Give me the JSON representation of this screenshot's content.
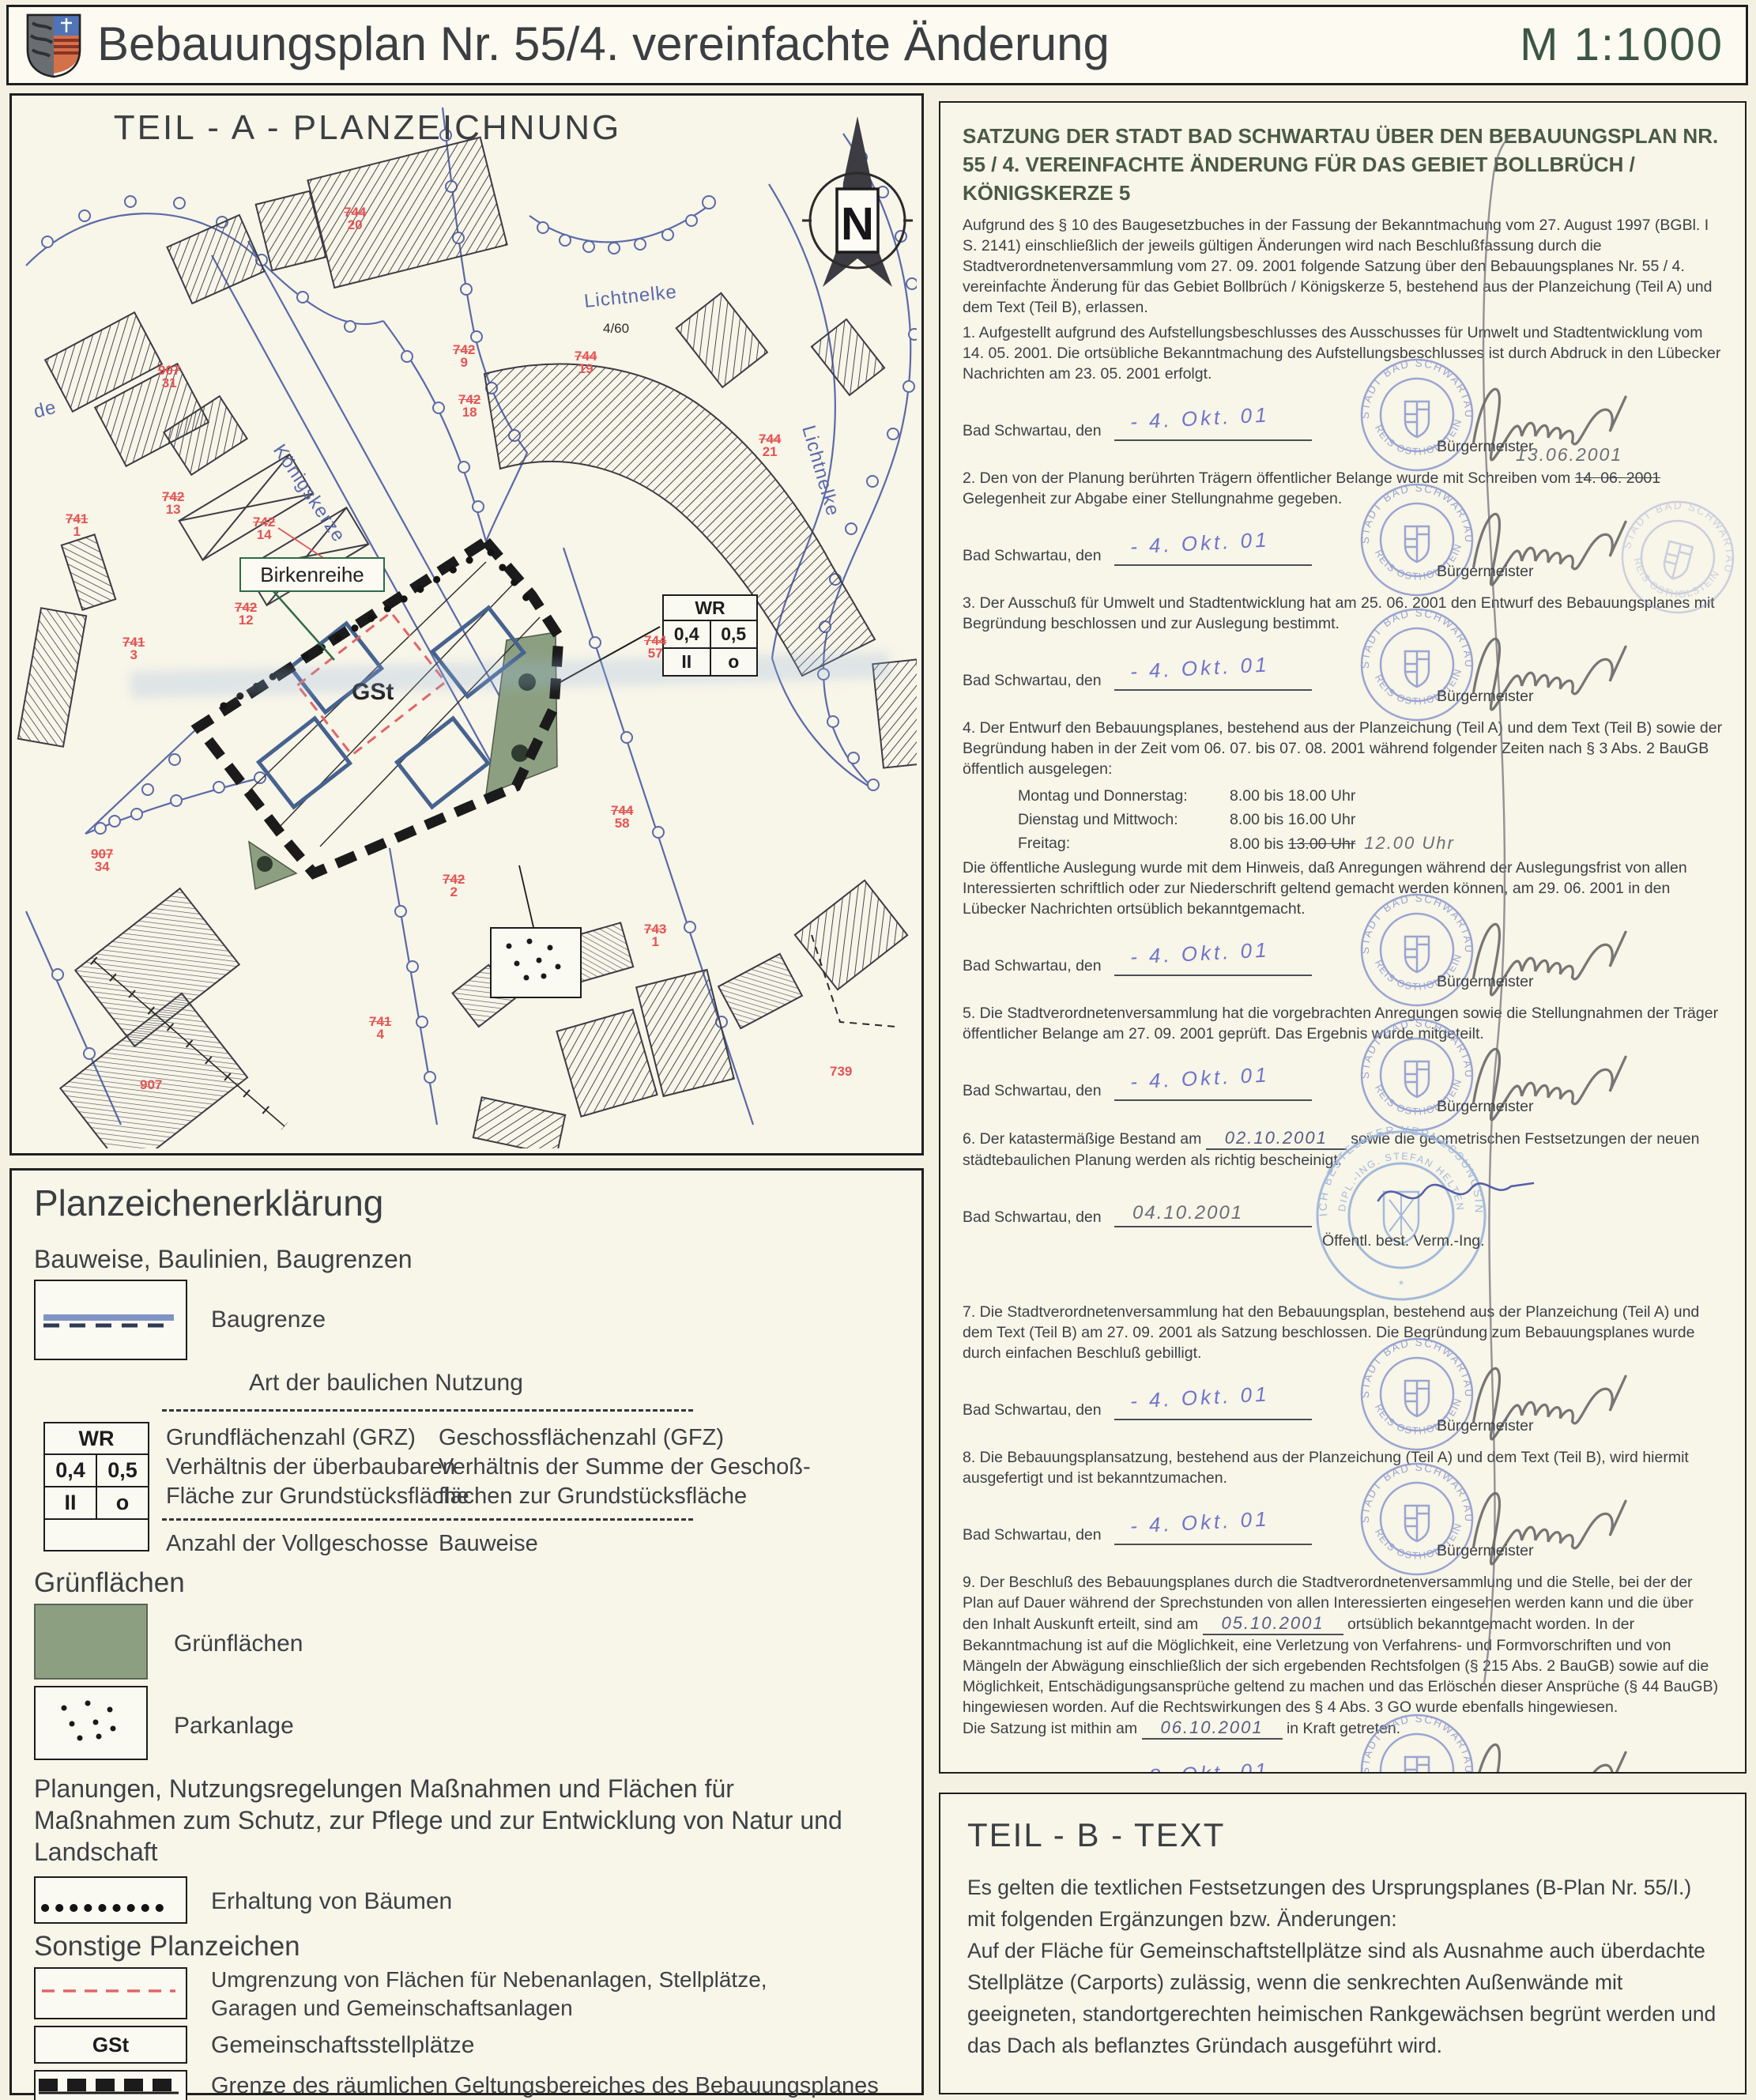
{
  "header": {
    "title": "Bebauungsplan Nr. 55/4. vereinfachte Änderung",
    "scale": "M 1:1000"
  },
  "plan": {
    "title": "TEIL - A - PLANZEICHNUNG",
    "north": "N",
    "streets": {
      "lichtnelke_top": "Lichtnelke",
      "lichtnelke_right": "Lichtnelke",
      "koenigskerze": "Königskerze",
      "de": "de"
    },
    "birkenreihe": "Birkenreihe",
    "gst": "GSt",
    "flur": "4/60",
    "wr_table": {
      "header": "WR",
      "grz": "0,4",
      "gfz": "0,5",
      "storeys": "II",
      "bauweise": "o"
    },
    "parcels": [
      {
        "top": "744",
        "bottom": "20"
      },
      {
        "top": "907",
        "bottom": "31"
      },
      {
        "top": "742",
        "bottom": "13"
      },
      {
        "top": "741",
        "bottom": "1"
      },
      {
        "top": "742",
        "bottom": "14"
      },
      {
        "top": "742",
        "bottom": "12"
      },
      {
        "top": "741",
        "bottom": "3"
      },
      {
        "top": "742",
        "bottom": "9"
      },
      {
        "top": "742",
        "bottom": "18"
      },
      {
        "top": "744",
        "bottom": "19"
      },
      {
        "top": "744",
        "bottom": "21"
      },
      {
        "top": "744",
        "bottom": "57"
      },
      {
        "top": "744",
        "bottom": "58"
      },
      {
        "top": "742",
        "bottom": "2"
      },
      {
        "top": "743",
        "bottom": "1"
      },
      {
        "top": "907",
        "bottom": "34"
      },
      {
        "top": "741",
        "bottom": "4"
      }
    ],
    "parcels_single": {
      "p907": "907",
      "p739": "739"
    }
  },
  "legend": {
    "title": "Planzeichenerklärung",
    "subtitle": "Bauweise, Baulinien, Baugrenzen",
    "baugrenze": "Baugrenze",
    "art": "Art der baulichen Nutzung",
    "grz": "Grundflächenzahl (GRZ)\nVerhältnis der überbaubaren\nFläche zur Grundstücksfläche",
    "gfz": "Geschossflächenzahl (GFZ)\nVerhältnis der Summe der Geschoß-\nflächen zur Grundstücksfläche",
    "anzahl": "Anzahl der Vollgeschosse",
    "bauweise": "Bauweise",
    "gruen_heading": "Grünflächen",
    "gruen": "Grünflächen",
    "park": "Parkanlage",
    "plan_heading": "Planungen, Nutzungsregelungen Maßnahmen und Flächen für Maßnahmen zum Schutz, zur Pflege und zur Entwicklung von Natur und Landschaft",
    "erhaltung": "Erhaltung von Bäumen",
    "sonstige": "Sonstige Planzeichen",
    "umgrenzung": "Umgrenzung von Flächen für Nebenanlagen, Stellplätze, Garagen und Gemeinschaftsanlagen",
    "gst_sym": "GSt",
    "gst": "Gemeinschaftsstellplätze",
    "grenze": "Grenze des räumlichen Geltungsbereiches des Bebauungsplanes"
  },
  "satzung": {
    "title": "SATZUNG DER STADT BAD SCHWARTAU ÜBER DEN BEBAUUNGSPLAN NR. 55 / 4. VEREINFACHTE ÄNDERUNG FÜR DAS GEBIET BOLLBRÜCH / KÖNIGSKERZE 5",
    "intro": "Aufgrund des § 10 des Baugesetzbuches in der Fassung der Bekanntmachung vom 27. August 1997 (BGBl. I S. 2141) einschließlich der jeweils gültigen Änderungen wird nach Beschlußfassung durch die Stadtverordnetenversammlung vom 27. 09. 2001 folgende Satzung über den Bebauungsplanes Nr. 55 / 4. vereinfachte Änderung für das Gebiet Bollbrüch / Königskerze 5, bestehend aus der Planzeichung (Teil A) und dem Text (Teil B), erlassen.",
    "p1": "1. Aufgestellt aufgrund des Aufstellungsbeschlusses des Ausschusses für Umwelt und Stadtentwicklung vom 14. 05. 2001. Die ortsübliche Bekanntmachung des Aufstellungsbeschlusses ist durch Abdruck in den Lübecker Nachrichten am 23. 05. 2001 erfolgt.",
    "p2a": "2. Den von der Planung berührten Trägern öffentlicher Belange wurde mit Schreiben vom",
    "p2_struck": "14. 06. 2001",
    "p2b": "Gelegenheit  zur Abgabe einer Stellungnahme gegeben.",
    "hw_note": "13.06.2001",
    "p3": "3. Der Ausschuß für Umwelt und Stadtentwicklung hat am  25. 06. 2001 den Entwurf des Bebauungsplanes mit Begründung beschlossen und zur Auslegung bestimmt.",
    "p4a": "4. Der Entwurf den Bebauungsplanes, bestehend aus der Planzeichung (Teil A) und dem Text (Teil B) sowie der Begründung haben in der Zeit vom 06. 07. bis 07. 08. 2001 während folgender Zeiten nach § 3 Abs. 2 BauGB öffentlich ausgelegen:",
    "t1d": "Montag und Donnerstag:",
    "t1v": "8.00 bis 18.00 Uhr",
    "t2d": "Dienstag und Mittwoch:",
    "t2v": "8.00 bis 16.00 Uhr",
    "t3d": "Freitag:",
    "t3v": "8.00 bis",
    "t3_struck": "13.00 Uhr",
    "t3_hw": "12.00 Uhr",
    "p4b": "Die öffentliche Auslegung wurde mit dem Hinweis, daß  Anregungen während der Auslegungsfrist von allen Interessierten schriftlich oder zur Niederschrift geltend gemacht werden können, am 29. 06. 2001 in den Lübecker Nachrichten ortsüblich bekanntgemacht.",
    "p5": "5. Die Stadtverordnetenversammlung hat die vorgebrachten  Anregungen sowie die Stellungnahmen der Träger öffentlicher Belange am 27. 09. 2001 geprüft. Das Ergebnis wurde mitgeteilt.",
    "p6a": "6. Der katastermäßige Bestand am",
    "p6_hw": "02.10.2001",
    "p6b": "sowie die geometrischen Festsetzungen der neuen städtebaulichen Planung werden als richtig bescheinigt.",
    "p7": "7. Die Stadtverordnetenversammlung hat den Bebauungsplan,  bestehend aus der Planzeichung (Teil A) und dem Text (Teil B) am 27. 09. 2001 als Satzung beschlossen. Die Begründung zum Bebauungsplanes wurde durch einfachen Beschluß gebilligt.",
    "p8": "8. Die Bebauungsplansatzung, bestehend aus der Planzeichung (Teil A) und dem Text (Teil B), wird hiermit ausgefertigt und ist bekanntzumachen.",
    "p9a": "9. Der Beschluß des Bebauungsplanes durch die Stadtverordnetenversammlung und die Stelle, bei der der Plan auf Dauer während der Sprechstunden von allen Interessierten eingesehen werden kann und die über den Inhalt Auskunft erteilt, sind am",
    "p9_hw1": "05.10.2001",
    "p9b": "ortsüblich bekanntgemacht worden. In der Bekanntmachung ist auf die Möglichkeit, eine Verletzung von Verfahrens- und Formvorschriften und von Mängeln der Abwägung einschließlich der sich ergebenden Rechtsfolgen (§ 215 Abs. 2 BauGB) sowie auf die Möglichkeit, Entschädigungsansprüche geltend zu machen und das Erlöschen dieser Ansprüche (§ 44 BauGB) hingewiesen worden. Auf die Rechtswirkungen des § 4 Abs. 3 GO wurde ebenfalls hingewiesen.",
    "p9c": "Die Satzung ist mithin am",
    "p9_hw2": "06.10.2001",
    "p9d": "in Kraft getreten.",
    "sig_label": "Bad Schwartau, den",
    "role_mayor": "Bürgermeister",
    "role_surveyor": "Öffentl. best. Verm.-Ing.",
    "d1": "- 4. Okt. 01",
    "d2": "- 4. Okt. 01",
    "d3": "- 4. Okt. 01",
    "d4": "- 4. Okt. 01",
    "d5": "- 4. Okt. 01",
    "d6": "04.10.2001",
    "d7": "- 4. Okt. 01",
    "d8": "- 4. Okt. 01",
    "d9": "- 8. Okt. 01",
    "stamp_city_top": "STADT BAD SCHWARTAU",
    "stamp_city_bottom": "KREIS OSTHOLSTEIN",
    "stamp_surv_outer": "ÖFFENTLICH BESTELLTER VERMESSUNGSINGENIEUR",
    "stamp_surv_inner": "DIPL.-ING. STEFAN HELTEN"
  },
  "teil_b": {
    "title": "TEIL - B - TEXT",
    "body1": "Es gelten die textlichen Festsetzungen des Ursprungsplanes (B-Plan Nr. 55/I.) mit folgenden Ergänzungen bzw. Änderungen:",
    "body2": "Auf der Fläche für Gemeinschaftstellplätze sind als Ausnahme auch überdachte Stellplätze (Carports) zulässig, wenn die senkrechten Außenwände mit geeigneten, standortgerechten heimischen Rankgewächsen begrünt werden und das Dach als beflanztes Gründach ausgeführt wird."
  },
  "colors": {
    "map_blue": "#5a6aa8",
    "parcel_red": "#e25555",
    "green_area": "#8ca081",
    "stamp_blue": "#8a98cc",
    "title_green": "#4a5a44",
    "scale_green": "#3d5544"
  }
}
